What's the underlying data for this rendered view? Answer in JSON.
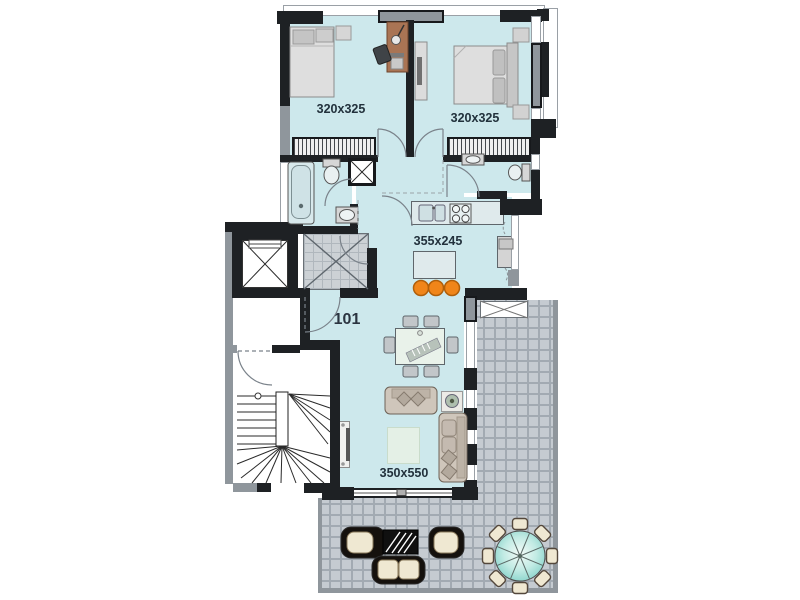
{
  "floor_plan": {
    "unit_label": "101",
    "rooms": {
      "bedroom_left": {
        "label": "320x325"
      },
      "bedroom_right": {
        "label": "320x325"
      },
      "kitchen": {
        "label": "355x245"
      },
      "living_room": {
        "label": "350x550"
      }
    },
    "colors": {
      "interior_fill": "#cde8ec",
      "wall": "#1e2124",
      "wall_gray": "#8f969c",
      "terrace_tile": "#c5cbd1",
      "terrace_grout": "#a2aab2",
      "bar_stool_accent": "#f08519",
      "outdoor_table_teal": "#86d2c9",
      "outdoor_cushion_cream": "#efe8d2",
      "desk_wood": "#a97454",
      "label_text": "#22313c"
    },
    "structures": [
      "elevator",
      "staircase",
      "entry-vestibule",
      "service-shaft",
      "terrace",
      "sliding-door",
      "windows",
      "wardrobes"
    ],
    "furniture": [
      "single-bed",
      "desk",
      "desk-chair",
      "double-bed",
      "nightstand",
      "tv-dresser",
      "bathtub",
      "toilet",
      "sink",
      "kitchen-counter",
      "kitchen-sink",
      "stove",
      "fridge",
      "kitchen-island",
      "bar-stools",
      "dining-table",
      "dining-chairs",
      "sofa",
      "side-table",
      "rug",
      "tv-unit",
      "outdoor-armchairs",
      "outdoor-coffee-table",
      "outdoor-loveseat",
      "outdoor-round-table",
      "outdoor-chairs"
    ]
  }
}
